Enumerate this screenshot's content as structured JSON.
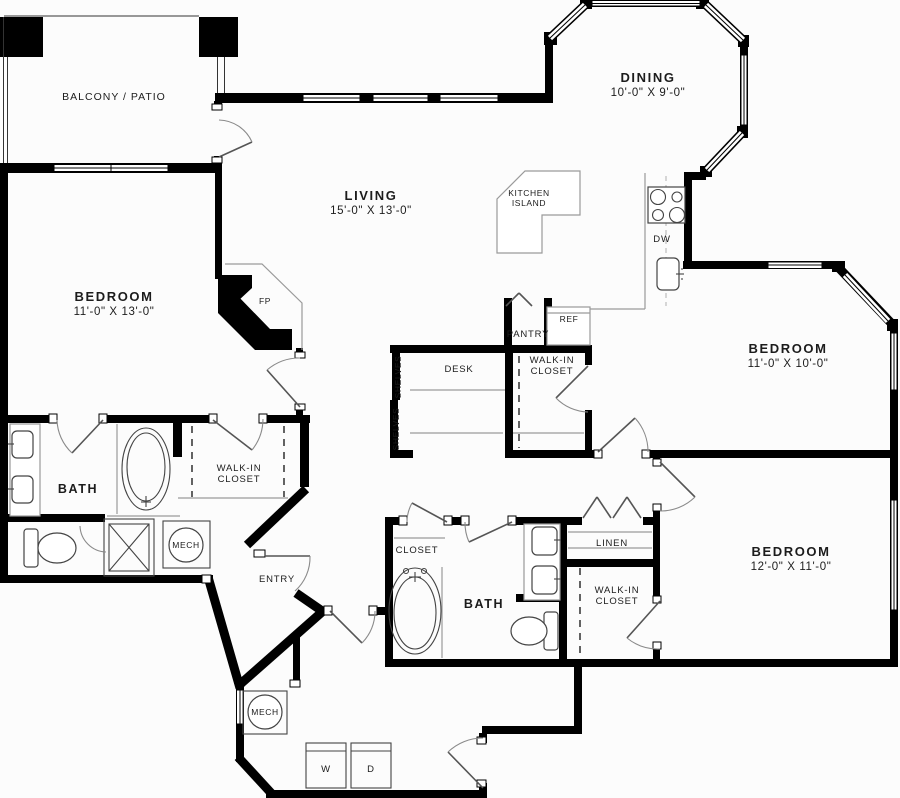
{
  "colors": {
    "wall": "#000000",
    "thin_line": "#9a9a9a",
    "fixture_line": "#444444",
    "text": "#1c1c1c",
    "background": "#fcfcfc"
  },
  "rooms": {
    "balcony": {
      "label": "BALCONY / PATIO"
    },
    "dining": {
      "label": "DINING",
      "dims": "10'-0\" X 9'-0\""
    },
    "living": {
      "label": "LIVING",
      "dims": "15'-0\" X 13'-0\""
    },
    "kitchen_island": {
      "line1": "KITCHEN",
      "line2": "ISLAND"
    },
    "bedroom_left": {
      "label": "BEDROOM",
      "dims": "11'-0\" X 13'-0\""
    },
    "bedroom_right": {
      "label": "BEDROOM",
      "dims": "11'-0\" X 10'-0\""
    },
    "bedroom_bottom": {
      "label": "BEDROOM",
      "dims": "12'-0\" X 11'-0\""
    },
    "bath_main": {
      "label": "BATH"
    },
    "bath_second": {
      "label": "BATH"
    },
    "entry": {
      "label": "ENTRY"
    }
  },
  "features": {
    "walk_in_closet": {
      "line1": "WALK-IN",
      "line2": "CLOSET"
    },
    "pantry": "PANTRY",
    "refrigerator": "REF",
    "dishwasher": "DW",
    "desk": "DESK",
    "shelves": "SHELVES",
    "mechanical": "MECH",
    "closet": "CLOSET",
    "linen": "LINEN",
    "washer": "W",
    "dryer": "D",
    "fireplace": "FP"
  }
}
